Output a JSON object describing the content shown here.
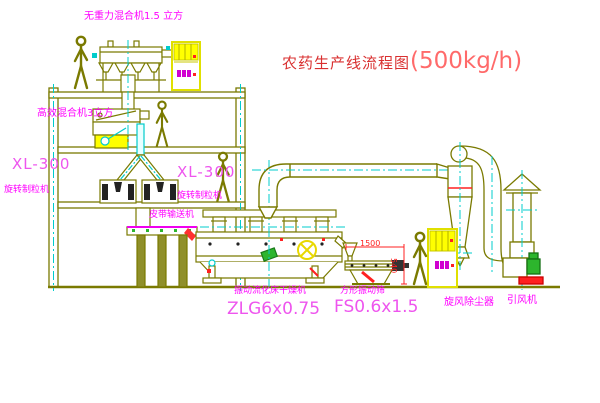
{
  "title": {
    "name": "农药生产线流程图",
    "capacity": "(500kg/h)"
  },
  "labels": {
    "gravity_free_mixer": "无重力混合机1.5 立方",
    "high_efficiency_mixer": "高效混合机3立方",
    "granulator_left_model": "XL-300",
    "granulator_left_name": "旋转制粒机",
    "granulator_mid_model": "XL-300",
    "granulator_mid_name": "旋转制粒机",
    "belt_conveyor": "皮带输送机",
    "dryer_name": "振动流化床干燥机",
    "dryer_model": "ZLG6x0.75",
    "sieve_name": "方形振动筛",
    "sieve_model": "FS0.6x1.5",
    "cyclone": "旋风除尘器",
    "fan": "引风机"
  },
  "dimensions": {
    "sieve_length": "1500",
    "sieve_height": "540"
  },
  "colors": {
    "drawing_line": "#7a7a00",
    "centerline_cyan": "#00cccc",
    "label_magenta": "#ff00ff",
    "title_red": "#d93030",
    "capacity_red": "#ff6a6a",
    "dimension_red": "#ff2020",
    "cabinet_yellow": "#ffff00",
    "motor_green": "#2db52d"
  }
}
